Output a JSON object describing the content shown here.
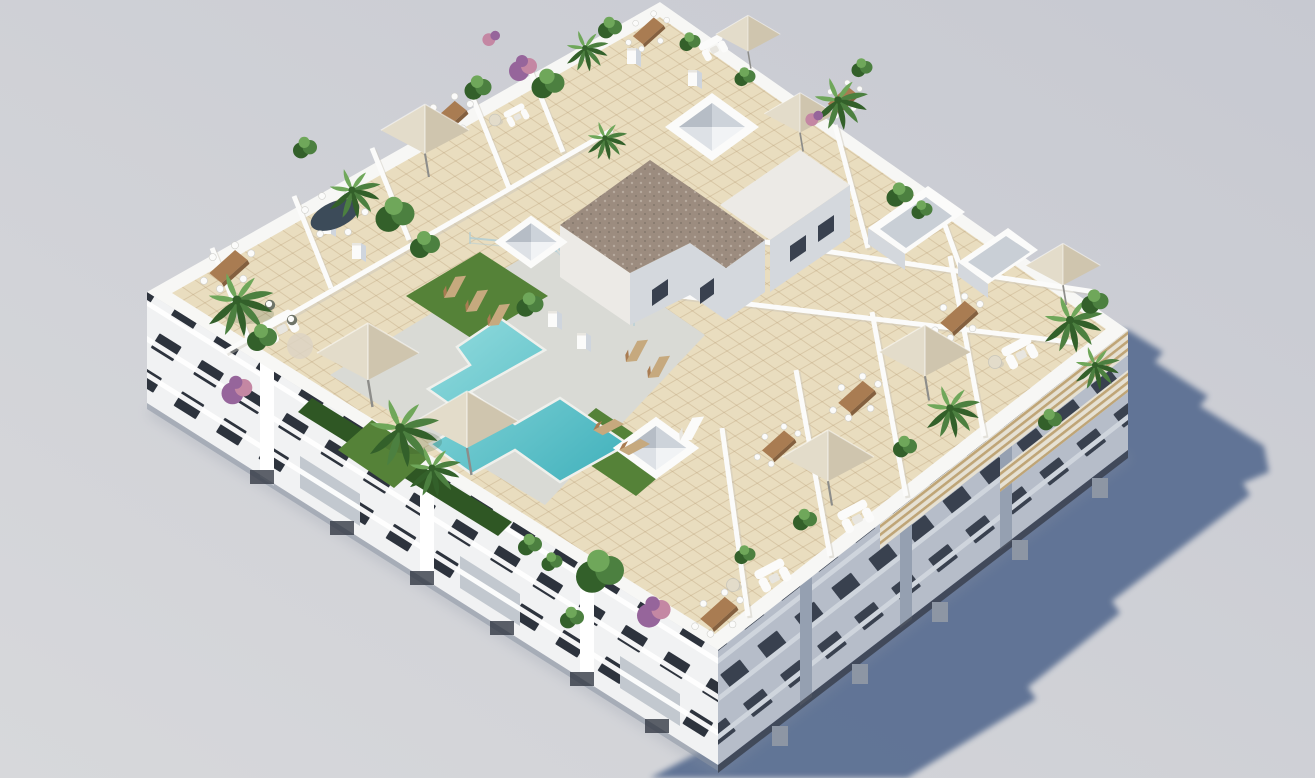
{
  "scene": {
    "type": "3d-architectural-render",
    "title": "Aerial 3D rendering of a white residential apartment block seen from above, with rooftop solarium terraces and a communal swimming pool",
    "setting": "Isometric bird's-eye view; sunlight from the upper left casts a long jagged blue-grey shadow onto plain grey ground at the lower right",
    "no_visible_text": true
  },
  "inventory": {
    "visible_floors_below_roof": 3,
    "rooftop_private_terraces": 12,
    "communal_pool": 1,
    "pool_shape": "stepped Z-shape",
    "pyramid_skylights": 3,
    "sunken_planter_boxes": 2,
    "parasols": 8,
    "dining_table_sets": 8,
    "outdoor_sofas": 6,
    "sun_loungers": 8,
    "palm_trees": 10,
    "shrubs_and_pot_plants": 22,
    "purple_flowering_trees": 3,
    "pergola_slat_bands": 3,
    "chimney_stacks": 6
  },
  "palette": {
    "bg_top": "#c7c9d1",
    "bg_bottom": "#d7d8db",
    "shadow": "#5c6f93",
    "parapet": "#f7f7f5",
    "deck": "#e9ddbf",
    "tile_line": "#b59c72",
    "deck_gray": "#d9dad5",
    "facade_sw": "#f1f2f3",
    "facade_se": "#b6bdc9",
    "facade_ne": "#a6aebd",
    "slab_light": "#ffffff",
    "slab_se": "#cfd5dd",
    "window_sw": "#2d333d",
    "window_se": "#39414f",
    "pilaster_se": "#95a0b1",
    "balcony_recess": "#c2c8cf",
    "base_dark": "#343a45",
    "base_gray": "#8d96a4",
    "pergola_bg": "#e6e1d3",
    "pergola_line": "#bfa577",
    "stair_roof": "#9c8c7f",
    "stair_dot": "#b7aa9e",
    "stair_dot2": "#877a6e",
    "stair_wall": "#eceae6",
    "stair_wall_shade": "#d4d8dd",
    "sky_dark": "#b6bdc6",
    "sky_mid": "#cdd3da",
    "sky_mid2": "#dde1e6",
    "sky_light": "#f1f3f5",
    "inner_box": "#c9cfd6",
    "pool_light": "#93dcde",
    "pool_dark": "#3fb0bb",
    "pool_coping": "#eff0ec",
    "grass": "#558238",
    "hedge": "#2f5724",
    "leaf": "#4c8040",
    "leaf_dark": "#33602a",
    "leaf_light": "#6fa75a",
    "purple": "#96659b",
    "pink": "#c487a3",
    "wood": "#a97c52",
    "wood_dark": "#84603f",
    "tan": "#c6a97e",
    "umbrella_light": "#e3dcca",
    "umbrella_dark": "#cfc5ae",
    "pole": "#8d8d8a",
    "white": "#fbfbfa",
    "offwhite": "#e8e6e0",
    "soft_gray": "#c9c6bb",
    "glass": "#aecdd6",
    "oval_table": "#3c4b59",
    "wicker": "#6f7468"
  }
}
